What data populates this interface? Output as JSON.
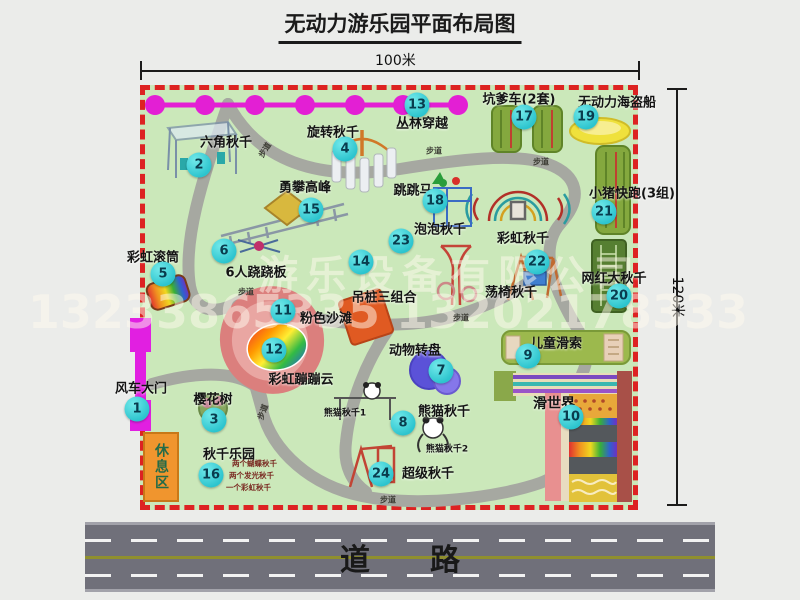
{
  "title": "无动力游乐园平面布局图",
  "dimensions": {
    "top": "100米",
    "right": "120米"
  },
  "road": {
    "label": "道路"
  },
  "watermark": {
    "company": "游乐设备有限公司",
    "phone": "13233865335 13202178333"
  },
  "attractions": [
    {
      "num": "1",
      "name": "风车大门"
    },
    {
      "num": "2",
      "name": "六角秋千"
    },
    {
      "num": "3",
      "name": "樱花树"
    },
    {
      "num": "4",
      "name": "旋转秋千"
    },
    {
      "num": "5",
      "name": "彩虹滚筒"
    },
    {
      "num": "6",
      "name": "6人跷跷板"
    },
    {
      "num": "7",
      "name": "动物转盘"
    },
    {
      "num": "8",
      "name": "熊猫秋千"
    },
    {
      "num": "9",
      "name": "儿童滑索"
    },
    {
      "num": "10",
      "name": "滑世界"
    },
    {
      "num": "11",
      "name": "粉色沙滩"
    },
    {
      "num": "12",
      "name": "彩虹蹦蹦云"
    },
    {
      "num": "13",
      "name": "丛林穿越"
    },
    {
      "num": "14",
      "name": "吊桩三组合"
    },
    {
      "num": "15",
      "name": "勇攀高峰"
    },
    {
      "num": "16",
      "name": "秋千乐园"
    },
    {
      "num": "17",
      "name": "坑爹车(2套)"
    },
    {
      "num": "18",
      "name": "跳跳马"
    },
    {
      "num": "19",
      "name": "无动力海盗船"
    },
    {
      "num": "20",
      "name": "网红大秋千"
    },
    {
      "num": "21",
      "name": "小猪快跑(3组)"
    },
    {
      "num": "22",
      "name": "荡椅秋千"
    },
    {
      "num": "23",
      "name": "泡泡秋千"
    },
    {
      "num": "24",
      "name": "超级秋千"
    }
  ],
  "extra_labels": {
    "rainbow_swing": "彩虹秋千",
    "panda_swing_1": "熊猫秋千1",
    "panda_swing_2": "熊猫秋千2",
    "rest_area": "休息区",
    "footpath": "步道",
    "swing_park_details": [
      "两个蝴蝶秋千",
      "两个发光秋千",
      "一个彩虹秋千"
    ]
  },
  "colors": {
    "map_green": "#cbe8ba",
    "border_red": "#dd2222",
    "path_gray": "#a6a8a1",
    "badge_cyan": "#2cc4ce",
    "chain_magenta": "#e31fd4",
    "gate_magenta": "#e11fe1",
    "rest_orange": "#f0952e"
  }
}
